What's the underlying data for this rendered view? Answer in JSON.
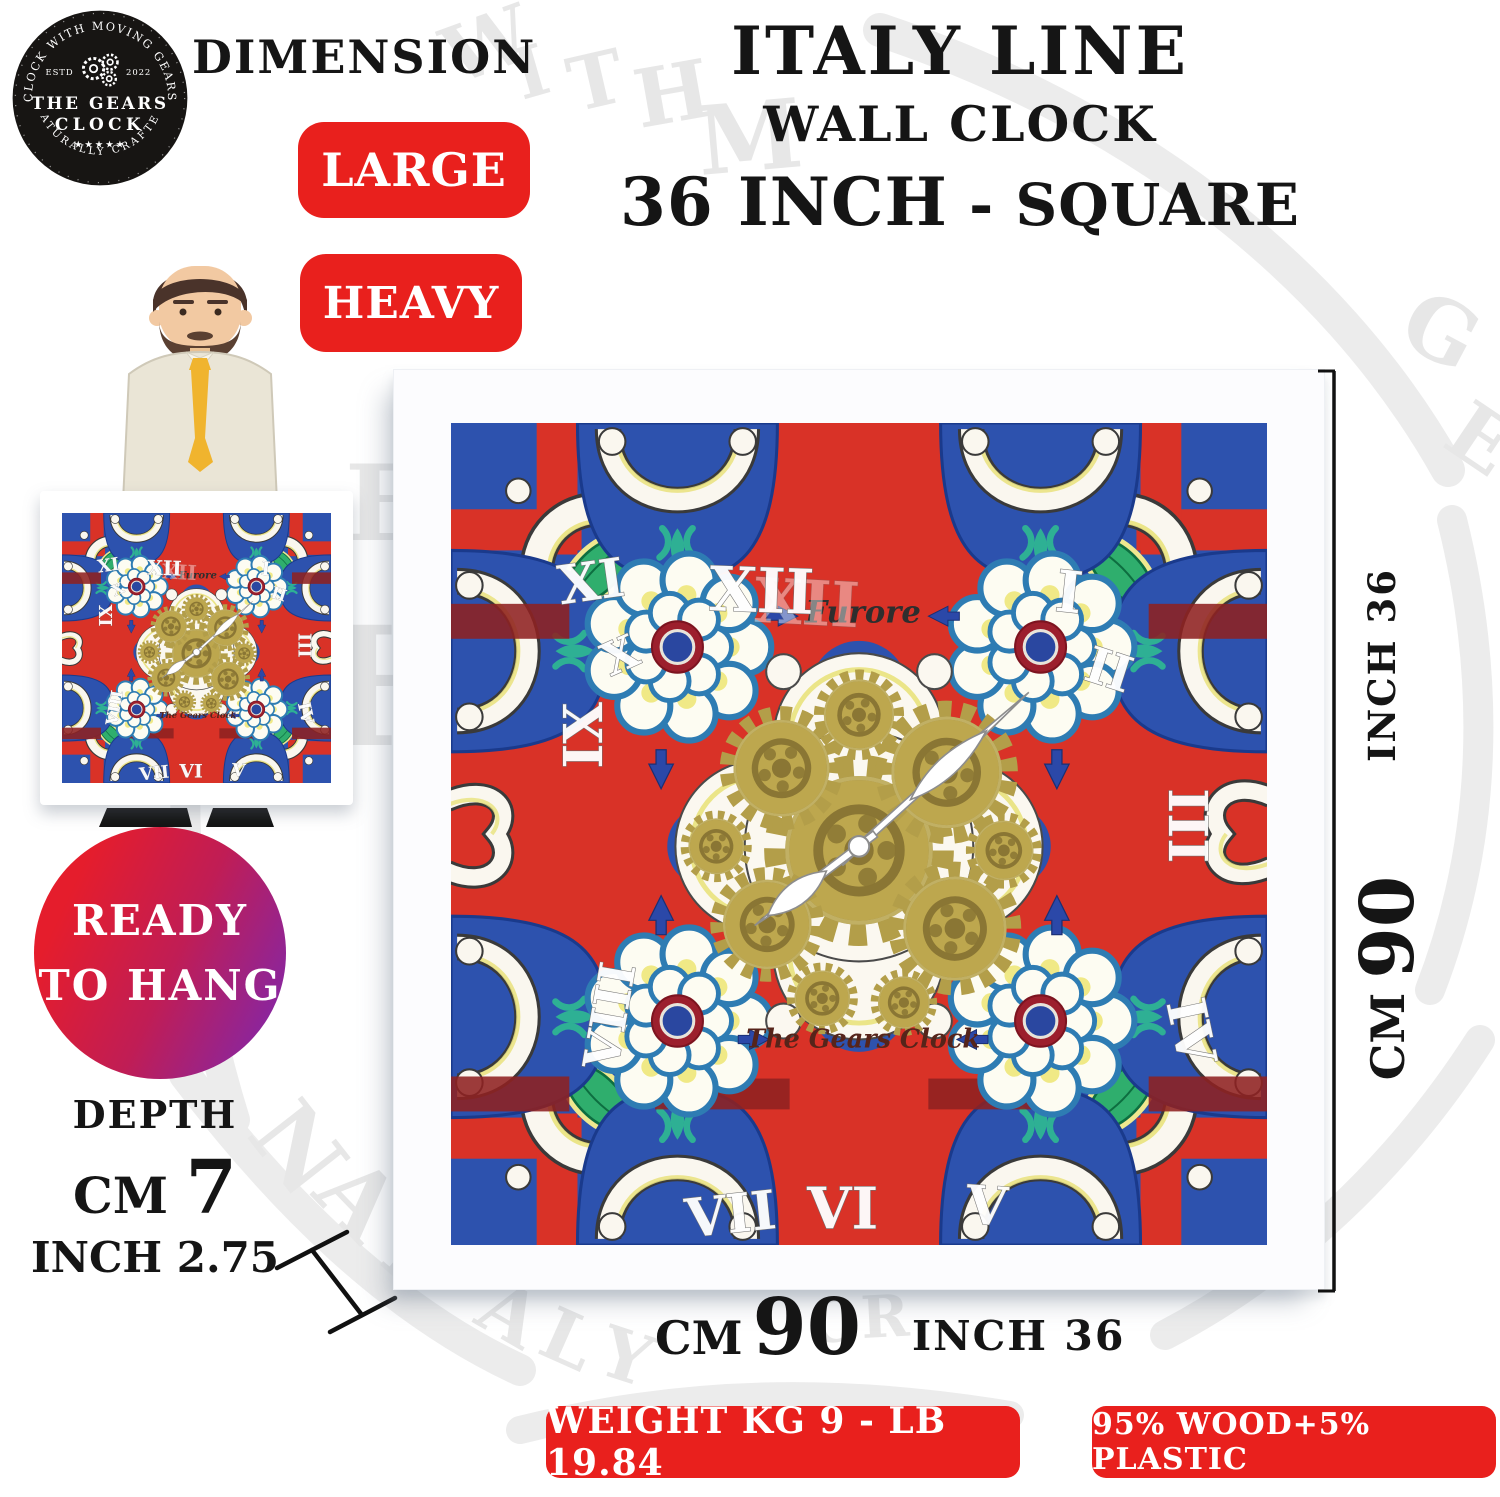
{
  "logo": {
    "arc_top": "CLOCK WITH MOVING GEARS",
    "estd": "ESTD",
    "year": "2022",
    "name_line1": "THE GEARS",
    "name_line2": "CLOCK",
    "stars": "★★★★★",
    "arc_bottom": "NATURALLY CRAFTED"
  },
  "header": {
    "dimension_label": "DIMENSION",
    "title_line1": "ITALY LINE",
    "title_line2": "WALL CLOCK",
    "title_size": "36 INCH",
    "title_shape": "- SQUARE"
  },
  "badges": {
    "large": "LARGE",
    "heavy": "HEAVY"
  },
  "ready_badge": {
    "line1": "READY",
    "line2": "TO HANG"
  },
  "depth": {
    "label": "DEPTH",
    "cm_label": "CM",
    "cm_value": "7",
    "inch_label": "INCH",
    "inch_value": "2.75"
  },
  "right_dimension": {
    "inch": "INCH 36",
    "cm_label": "CM",
    "cm_value": "90"
  },
  "bottom_dimension": {
    "cm_label": "CM",
    "cm_value": "90",
    "inch": "INCH 36"
  },
  "clock": {
    "brand_top": "Furore",
    "brand_bottom": "The Gears Clock",
    "numerals": [
      "XII",
      "I",
      "II",
      "III",
      "IV",
      "V",
      "VI",
      "VII",
      "VIII",
      "IX",
      "X",
      "XI"
    ]
  },
  "footer": {
    "weight": "WEIGHT KG 9 - LB 19.84",
    "material": "95% WOOD+5% PLASTIC"
  },
  "colors": {
    "badge_red": "#e9201d",
    "face_red": "#d93227",
    "face_blue": "#2d52ae",
    "maroon": "#8e2121",
    "gear_gold": "#bda74e",
    "leaf_green": "#2fae6d",
    "accent_yellow": "#e9e27c",
    "gradient_red": "#e51d2c",
    "gradient_purple": "#7f27ad"
  }
}
